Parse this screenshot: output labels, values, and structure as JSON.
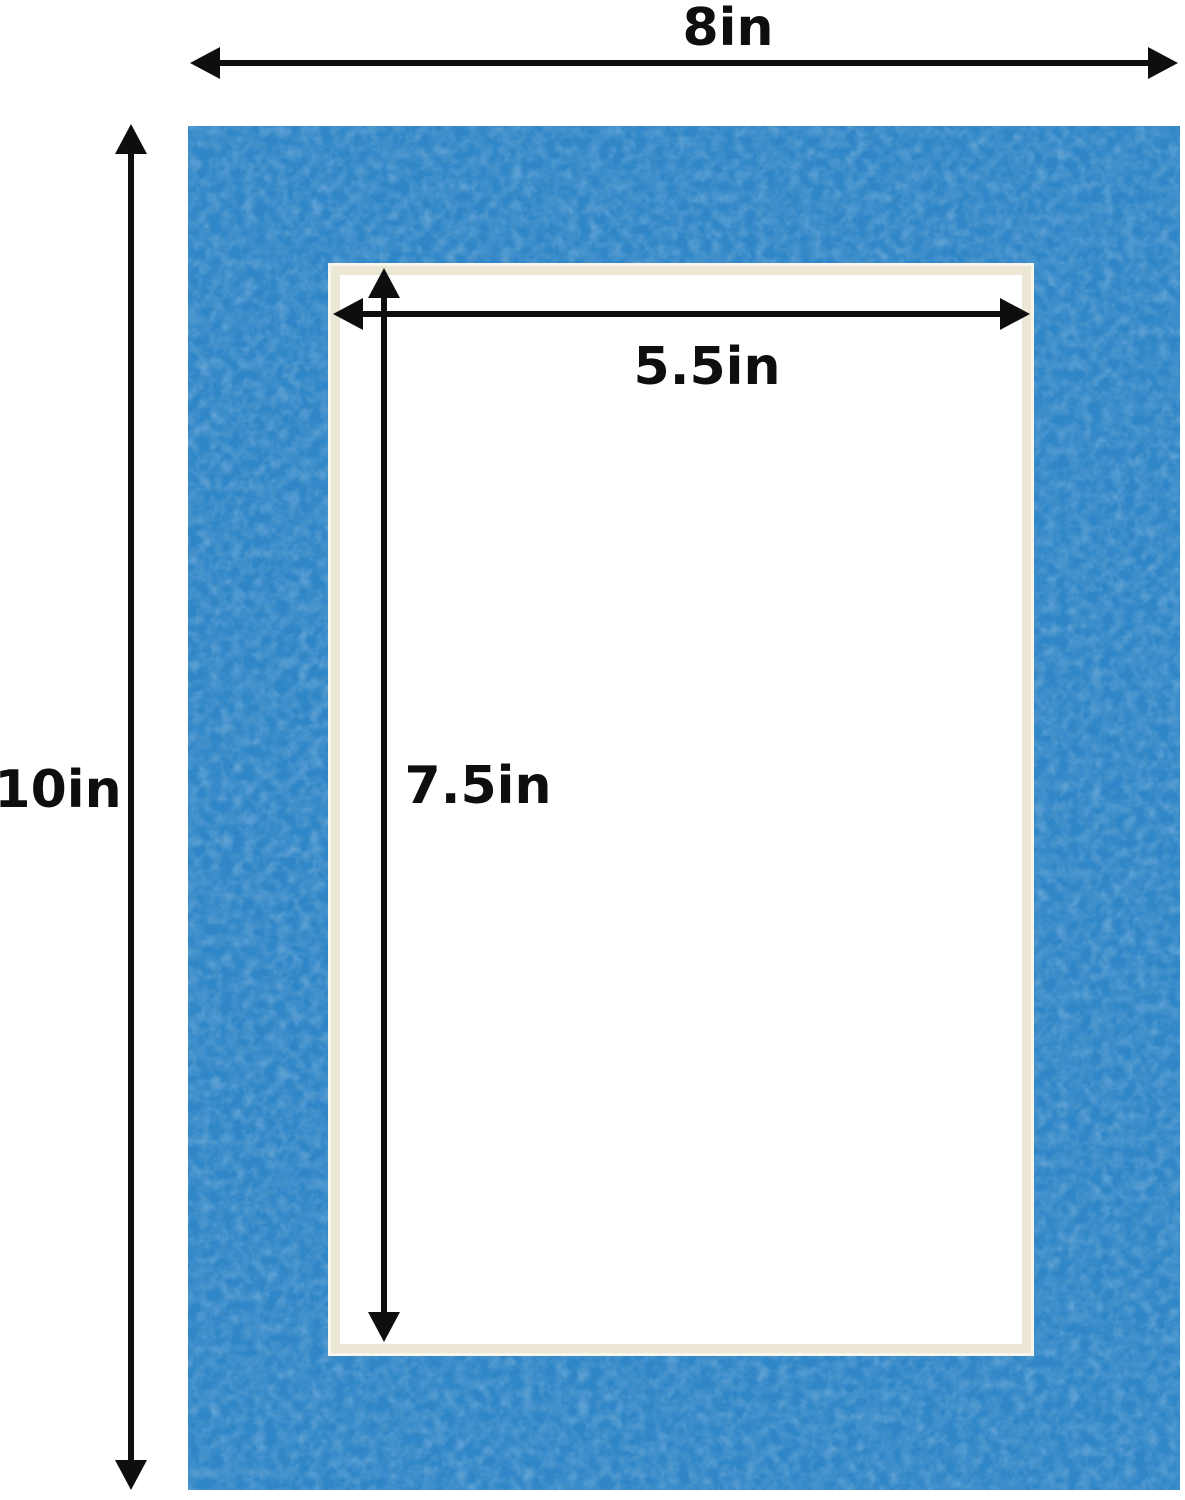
{
  "figure": {
    "description": "Dimension diagram of a blue picture-frame mat board with a rectangular cut opening",
    "labels": {
      "outer_width": "8in",
      "outer_height": "10in",
      "opening_width": "5.5in",
      "opening_height": "7.5in"
    },
    "colors": {
      "mat_blue": "#2F86C8",
      "bevel_cream": "#ECE6D4",
      "bevel_highlight": "#F8F5EC",
      "dimension_black": "#0E0E0E",
      "background": "#FFFFFF"
    }
  }
}
